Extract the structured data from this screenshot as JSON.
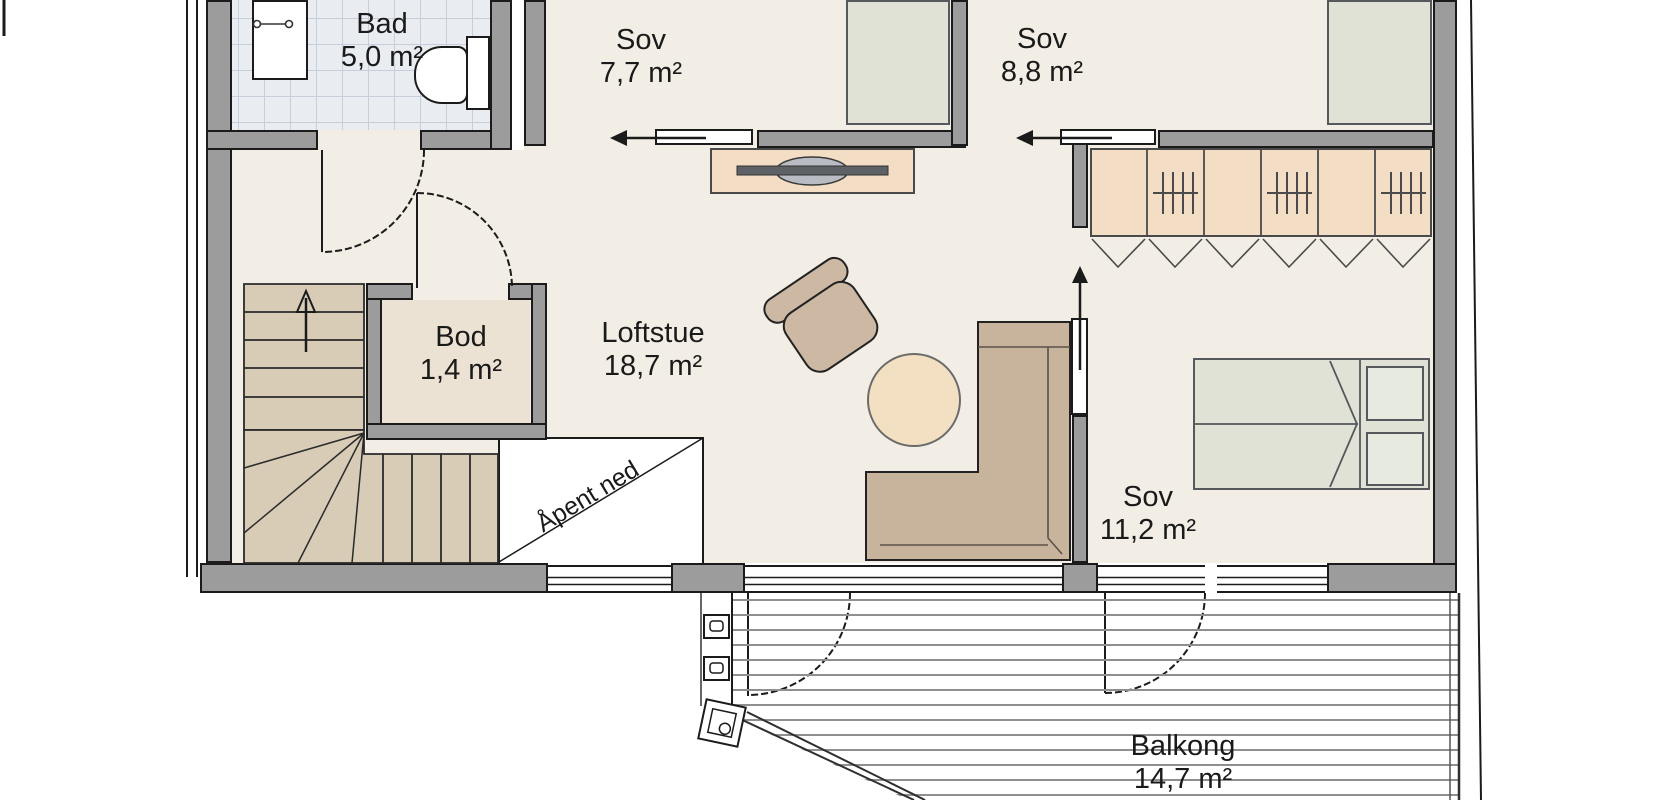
{
  "rooms": {
    "bad": {
      "name": "Bad",
      "area": "5,0 m²"
    },
    "sov_1": {
      "name": "Sov",
      "area": "7,7 m²"
    },
    "sov_2": {
      "name": "Sov",
      "area": "8,8 m²"
    },
    "bod": {
      "name": "Bod",
      "area": "1,4 m²"
    },
    "loftstue": {
      "name": "Loftstue",
      "area": "18,7 m²"
    },
    "sov_3": {
      "name": "Sov",
      "area": "11,2 m²"
    },
    "balkong": {
      "name": "Balkong",
      "area": "14,7 m²"
    }
  },
  "annotations": {
    "open_below": "Åpent ned"
  },
  "colors": {
    "floor": "#f2eee6",
    "wall_fill": "#9c9c9c",
    "outline": "#1b1b1b",
    "bathroom_tile": "#e9ecf1",
    "stair_tread": "#d8ccb7",
    "wood_furniture": "#f3dec5",
    "upholstery": "#c8b39c",
    "pouf": "#f3e0c3",
    "bed_linen": "#dfe2d4",
    "bod_floor": "#ece2d3",
    "deck_line": "#8f8f8f"
  }
}
